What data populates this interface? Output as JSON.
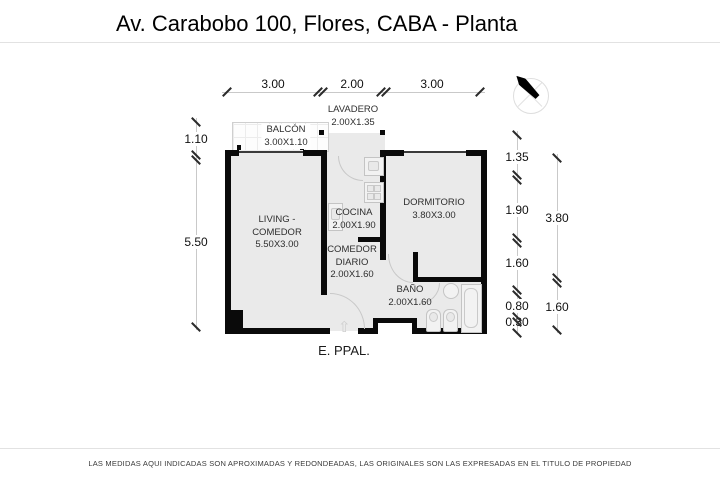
{
  "title": "Av. Carabobo 100, Flores, CABA - Planta",
  "footer_disclaimer": "LAS MEDIDAS AQUI INDICADAS SON APROXIMADAS Y REDONDEADAS, LAS ORIGINALES SON LAS EXPRESADAS EN EL TITULO DE PROPIEDAD",
  "plan": {
    "entrance_label": "E. PPAL.",
    "entrance_arrow_glyph": "⇧",
    "rooms": {
      "lavadero": {
        "name": "LAVADERO",
        "size": "2.00X1.35"
      },
      "balcon": {
        "name": "BALCÓN",
        "size": "3.00X1.10"
      },
      "living": {
        "name_line1": "LIVING -",
        "name_line2": "COMEDOR",
        "size": "5.50X3.00"
      },
      "cocina": {
        "name": "COCINA",
        "size": "2.00X1.90"
      },
      "comedor_diario": {
        "name_line1": "COMEDOR",
        "name_line2": "DIARIO",
        "size": "2.00X1.60"
      },
      "dormitorio": {
        "name": "DORMITORIO",
        "size": "3.80X3.00"
      },
      "bano": {
        "name": "BAÑO",
        "size": "2.00X1.60"
      }
    },
    "dimensions": {
      "top": {
        "d1": "3.00",
        "d2": "2.00",
        "d3": "3.00"
      },
      "left": {
        "d1": "1.10",
        "d2": "5.50"
      },
      "right_inner": {
        "d1": "1.35",
        "d2": "1.90",
        "d3": "1.60",
        "d4": "0.80",
        "d5": "0.30"
      },
      "right_outer": {
        "d1": "3.80",
        "d2": "1.60"
      }
    }
  },
  "colors": {
    "wall": "#0a0a0a",
    "floor": "#eaeaea",
    "dimension_line": "#c9c9c9",
    "fixture_outline": "#c4c4c4",
    "background": "#ffffff"
  }
}
